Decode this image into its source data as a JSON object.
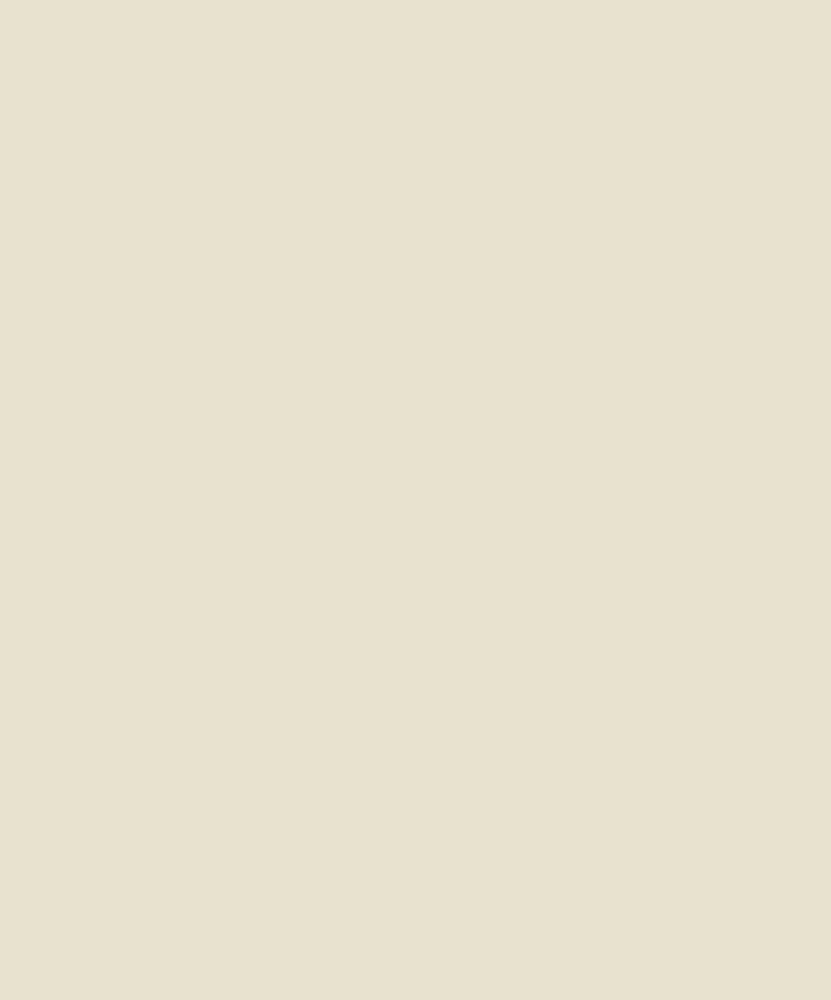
{
  "document": {
    "kind": "scanned hand-drawn park plan, ink and wash on aged paper",
    "visible_text": []
  },
  "palette": {
    "mat": "#f1ebd9",
    "paper": "#d8c59c",
    "pencil": "#6e6853",
    "outline": "#7d7459",
    "parkBase": "#c6b78e",
    "tree": "#8b8264",
    "treeDark": "#5f5a44",
    "meadow": "#dccca2",
    "pond": "#e3d6b0",
    "lawn": "#c5c2a2",
    "panel": "#cfc098",
    "roadFill": "#ddcea5",
    "roadCase": "#55503c",
    "median": "#b3a982",
    "ink": "#191610",
    "stain": "#8a6b3a",
    "spot": "#a4752f"
  },
  "canvas": {
    "width": 831,
    "height": 1000
  },
  "landmarks": [
    {
      "name": "park-boundary",
      "bounds": [
        134,
        118,
        741,
        847
      ]
    },
    {
      "name": "great-meadow",
      "center": [
        310,
        415
      ]
    },
    {
      "name": "north-pond",
      "center": [
        272,
        180
      ]
    },
    {
      "name": "garden-pond",
      "center": [
        462,
        255
      ]
    },
    {
      "name": "formal-garden-fan",
      "center": [
        530,
        185
      ]
    },
    {
      "name": "conservatory-ring-building",
      "center": [
        530,
        185
      ]
    },
    {
      "name": "stadium-oval",
      "center": [
        456,
        152
      ]
    },
    {
      "name": "mall-with-buildings",
      "center": [
        578,
        420
      ]
    },
    {
      "name": "grand-radial-plaza",
      "center": [
        594,
        686
      ]
    },
    {
      "name": "plaza-fountain",
      "center": [
        594,
        686
      ]
    },
    {
      "name": "west-rondpoint",
      "center": [
        152,
        410
      ]
    },
    {
      "name": "southwest-rondpoint",
      "center": [
        310,
        697
      ]
    },
    {
      "name": "northwest-gate-structure",
      "center": [
        196,
        186
      ]
    },
    {
      "name": "northeast-traffic-circle",
      "center": [
        601,
        121
      ]
    },
    {
      "name": "meadow-pavilion",
      "center": [
        325,
        598
      ]
    },
    {
      "name": "southeast-annex",
      "bounds": [
        607,
        556,
        741,
        847
      ]
    },
    {
      "name": "southwest-boulevard",
      "from": [
        40,
        980
      ],
      "to": [
        594,
        686
      ]
    },
    {
      "name": "southeast-boulevard",
      "from": [
        594,
        686
      ],
      "to": [
        822,
        918
      ]
    },
    {
      "name": "northeast-boulevard",
      "from": [
        594,
        686
      ],
      "to": [
        820,
        462
      ]
    },
    {
      "name": "east-parkway",
      "from": [
        660,
        686
      ],
      "to": [
        816,
        686
      ]
    },
    {
      "name": "city-grid-west",
      "bounds": [
        12,
        5,
        134,
        960
      ]
    },
    {
      "name": "city-grid-north",
      "bounds": [
        134,
        0,
        607,
        118
      ]
    },
    {
      "name": "city-grid-east",
      "bounds": [
        607,
        5,
        816,
        960
      ]
    },
    {
      "name": "blank-south-area",
      "bounds": [
        134,
        847,
        740,
        985
      ]
    }
  ]
}
